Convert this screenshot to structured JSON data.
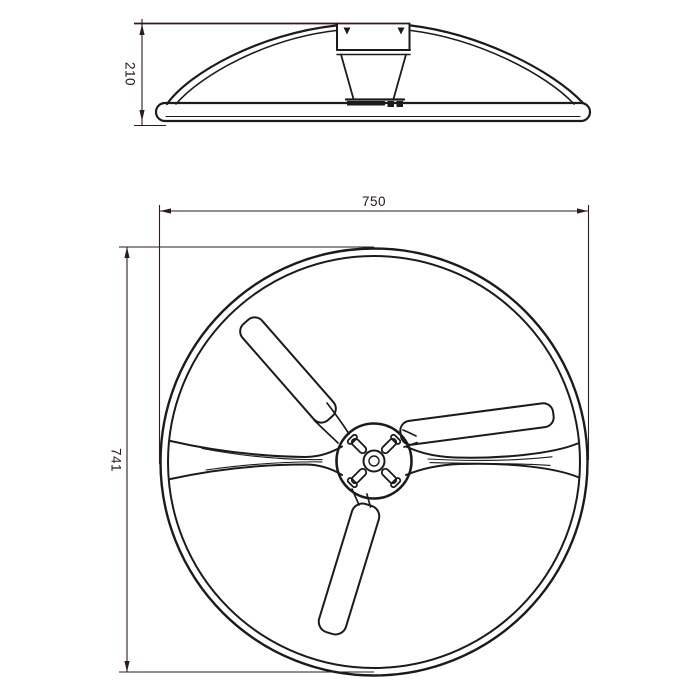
{
  "page": {
    "background_color": "#ffffff",
    "line_color": "#1b1b1b",
    "dimension_color": "#2e1c1a",
    "content": "two-view technical line drawing of a circular three-blade fan unit"
  },
  "drawing": {
    "side_view": {
      "description": "side elevation: domed housing on flat base bar with center mounting neck",
      "height_dim": "210"
    },
    "plan_view": {
      "description": "plan view: outer ring, diametral support arm, central hub with cross slots, three blades",
      "width_dim": "750",
      "height_dim": "741"
    }
  }
}
